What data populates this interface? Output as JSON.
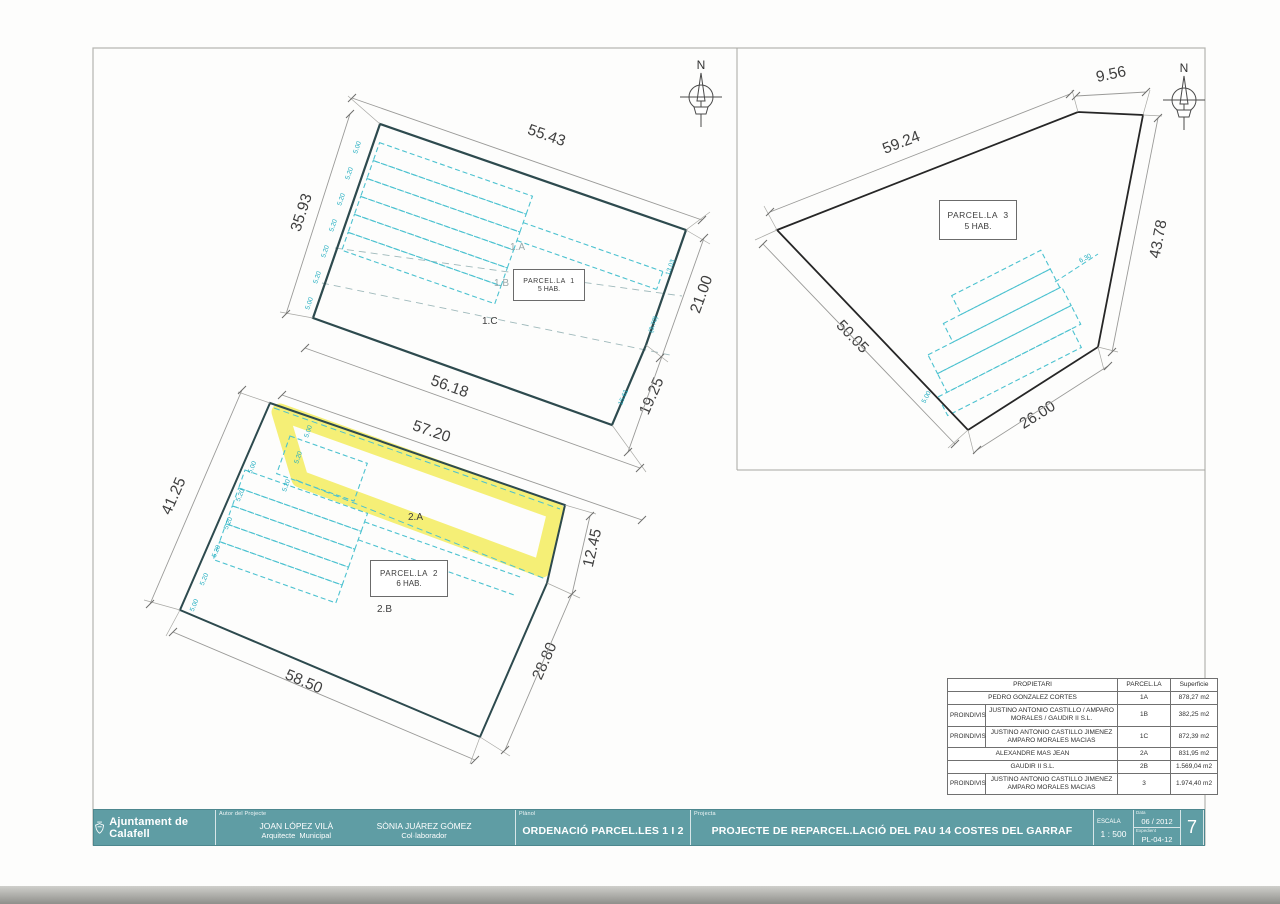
{
  "sheet": {
    "north_label": "N"
  },
  "colors": {
    "titleblock_teal": "#5f9da4",
    "highlight_yellow": "#f2eb4f",
    "plot_cyan": "#3fbccb",
    "outline_dark": "#2d4a4e"
  },
  "parcel1": {
    "box_title": "PARCEL.LA  1",
    "box_subtitle": "5 HAB.",
    "zone_a": "1.A",
    "zone_b": "1.B",
    "zone_c": "1.C",
    "dim_top": "55.43",
    "dim_left": "35.93",
    "dim_right_upper": "21.00",
    "dim_right_lower": "19.25",
    "dim_bottom": "56.18",
    "small_left": [
      "5.00",
      "5.20",
      "5.20",
      "5.20",
      "5.20",
      "5.20",
      "5.00"
    ],
    "small_right": [
      "13.03",
      "(3.70)",
      "15.61"
    ]
  },
  "parcel2": {
    "box_title": "PARCEL.LA  2",
    "box_subtitle": "6 HAB.",
    "zone_a": "2.A",
    "zone_b": "2.B",
    "dim_top": "57.20",
    "dim_left": "41.25",
    "dim_right_upper": "12.45",
    "dim_right_lower": "28.80",
    "dim_bottom": "58.50",
    "small_left": [
      "5.00",
      "5.20",
      "5.20",
      "5.20",
      "5.20",
      "5.00"
    ],
    "small_band": [
      "5.00",
      "5.20",
      "5.20"
    ]
  },
  "parcel3": {
    "box_title": "PARCEL.LA  3",
    "box_subtitle": "5 HAB.",
    "dim_top": "59.24",
    "dim_top_right": "9.56",
    "dim_right": "43.78",
    "dim_left": "50.05",
    "dim_bottom": "26.00",
    "small_right": "6.30",
    "small_left": "5.00"
  },
  "table": {
    "header_propietari": "PROPIETARI",
    "header_parcella": "PARCEL.LA",
    "header_superficie": "Superficie",
    "rows": [
      {
        "prefix": "",
        "name": "PEDRO GONZALEZ CORTES",
        "code": "1A",
        "area": "878,27 m2"
      },
      {
        "prefix": "PROINDIVIS",
        "name": "JUSTINO ANTONIO CASTILLO / AMPARO MORALES / GAUDIR II S.L.",
        "code": "1B",
        "area": "382,25 m2"
      },
      {
        "prefix": "PROINDIVIS",
        "name": "JUSTINO ANTONIO CASTILLO JIMENEZ AMPARO MORALES MACIAS",
        "code": "1C",
        "area": "872,39 m2"
      },
      {
        "prefix": "",
        "name": "ALEXANDRE MAS JEAN",
        "code": "2A",
        "area": "831,95 m2"
      },
      {
        "prefix": "",
        "name": "GAUDIR II S.L.",
        "code": "2B",
        "area": "1.569,04 m2"
      },
      {
        "prefix": "PROINDIVIS",
        "name": "JUSTINO ANTONIO CASTILLO JIMENEZ AMPARO MORALES MACIAS",
        "code": "3",
        "area": "1.974,40 m2"
      }
    ]
  },
  "title_block": {
    "logo_text": "Ajuntament de Calafell",
    "author_label": "Autor del Projecte",
    "author1_name": "JOAN LÓPEZ VILÀ",
    "author1_role": "Arquitecte  Municipal",
    "author2_name": "SÒNIA JUÁREZ GÓMEZ",
    "author2_role": "Col·laborador",
    "planol_label": "Plànol",
    "planol_value": "ORDENACIÓ PARCEL.LES 1 I 2",
    "projecte_label": "Projecta",
    "projecte_value": "PROJECTE DE REPARCEL.LACIÓ DEL PAU 14 COSTES DEL GARRAF",
    "escala_label": "ESCALA",
    "escala_value": "1 : 500",
    "data_label": "Data",
    "data_value": "06 / 2012",
    "ref_label": "Expedient",
    "ref_value": "PL-04-12",
    "sheet_number": "7"
  }
}
